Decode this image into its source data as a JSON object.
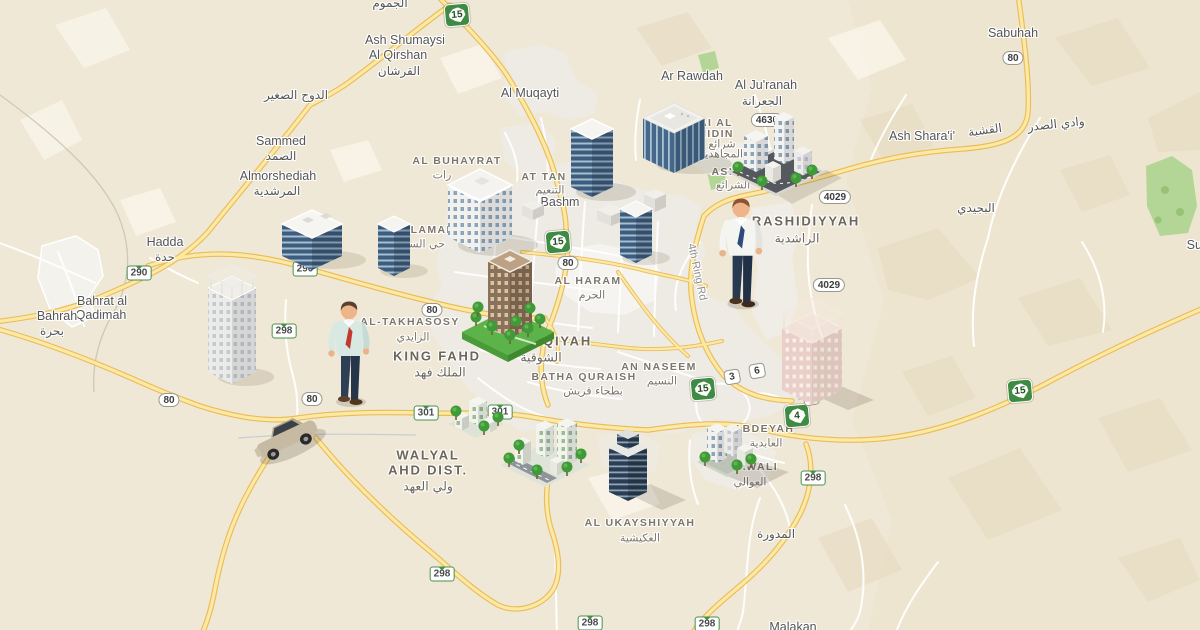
{
  "map": {
    "colors": {
      "background": "#f0e8d6",
      "urban": "#edebe4",
      "road_fill": "#fce9a6",
      "road_casing": "#eabc58",
      "road_local": "#ffffff",
      "green_area": "#b3d596",
      "terrain_shade": "#e3d6ba",
      "water": "#a8cae8",
      "shield_green": "#3f8b44"
    },
    "labels": [
      {
        "t": "الجموم",
        "x": 390,
        "y": 3,
        "c": "ar-town"
      },
      {
        "t": "Ash Shumaysi",
        "x": 405,
        "y": 40,
        "c": "town"
      },
      {
        "t": "Al Qirshan",
        "x": 398,
        "y": 55,
        "c": "town"
      },
      {
        "t": "القرشان",
        "x": 399,
        "y": 71,
        "c": "ar-town"
      },
      {
        "t": "Al Muqayti",
        "x": 530,
        "y": 93,
        "c": "town"
      },
      {
        "t": "الدوح الصغير",
        "x": 296,
        "y": 95,
        "c": "ar-town"
      },
      {
        "t": "Sammed",
        "x": 281,
        "y": 141,
        "c": "town"
      },
      {
        "t": "الصمد",
        "x": 281,
        "y": 156,
        "c": "ar-town"
      },
      {
        "t": "Almorshediah",
        "x": 278,
        "y": 176,
        "c": "town"
      },
      {
        "t": "المرشدية",
        "x": 277,
        "y": 191,
        "c": "ar-town"
      },
      {
        "t": "Hadda",
        "x": 165,
        "y": 242,
        "c": "town"
      },
      {
        "t": "حدة",
        "x": 165,
        "y": 257,
        "c": "ar-town"
      },
      {
        "t": "Bahrat al",
        "x": 102,
        "y": 301,
        "c": "town"
      },
      {
        "t": "Qadimah",
        "x": 101,
        "y": 315,
        "c": "town"
      },
      {
        "t": "Bahrah",
        "x": 57,
        "y": 316,
        "c": "town"
      },
      {
        "t": "بحرة",
        "x": 52,
        "y": 331,
        "c": "ar-town"
      },
      {
        "t": "AL BUHAYRAT",
        "x": 457,
        "y": 161,
        "c": "district"
      },
      {
        "t": "رات",
        "x": 442,
        "y": 175,
        "c": "ar-district"
      },
      {
        "t": "AT TAN",
        "x": 544,
        "y": 177,
        "c": "district"
      },
      {
        "t": "التنعيم",
        "x": 550,
        "y": 190,
        "c": "ar-district"
      },
      {
        "t": "Bashm",
        "x": 560,
        "y": 202,
        "c": "town"
      },
      {
        "t": "S SALAMAH",
        "x": 418,
        "y": 230,
        "c": "district"
      },
      {
        "t": "حي السلامة",
        "x": 418,
        "y": 244,
        "c": "ar-district"
      },
      {
        "t": "Ar Rawdah",
        "x": 692,
        "y": 76,
        "c": "town"
      },
      {
        "t": "Al Ju'ranah",
        "x": 766,
        "y": 85,
        "c": "town"
      },
      {
        "t": "الجعرانة",
        "x": 762,
        "y": 101,
        "c": "ar-town"
      },
      {
        "t": "ARAI AL",
        "x": 707,
        "y": 123,
        "c": "district"
      },
      {
        "t": "JAHIDIN",
        "x": 708,
        "y": 134,
        "c": "district"
      },
      {
        "t": "شرائع",
        "x": 722,
        "y": 144,
        "c": "ar-district"
      },
      {
        "t": "المجاهدين",
        "x": 720,
        "y": 154,
        "c": "ar-district"
      },
      {
        "t": "ASH S",
        "x": 731,
        "y": 172,
        "c": "district"
      },
      {
        "t": "الشرائع",
        "x": 733,
        "y": 185,
        "c": "ar-district"
      },
      {
        "t": "RASHIDIYYAH",
        "x": 806,
        "y": 221,
        "c": "district-big"
      },
      {
        "t": "الراشدية",
        "x": 797,
        "y": 238,
        "c": "ar-district-big"
      },
      {
        "t": "البجيدي",
        "x": 976,
        "y": 208,
        "c": "ar-town"
      },
      {
        "t": "Ash Shara'i'",
        "x": 922,
        "y": 136,
        "c": "town"
      },
      {
        "t": "القشبة",
        "x": 985,
        "y": 130,
        "c": "ar-town",
        "r": -8
      },
      {
        "t": "وادي الصدر",
        "x": 1056,
        "y": 124,
        "c": "ar-town",
        "r": -6
      },
      {
        "t": "Sabuhah",
        "x": 1013,
        "y": 33,
        "c": "town"
      },
      {
        "t": "Suf",
        "x": 1196,
        "y": 245,
        "c": "town"
      },
      {
        "t": "AL-TAKHASOSY",
        "x": 410,
        "y": 322,
        "c": "district"
      },
      {
        "t": "الزايدي",
        "x": 413,
        "y": 337,
        "c": "ar-district"
      },
      {
        "t": "KING FAHD",
        "x": 437,
        "y": 356,
        "c": "district-big"
      },
      {
        "t": "الملك فهد",
        "x": 440,
        "y": 372,
        "c": "ar-district-big"
      },
      {
        "t": "HOQIYAH",
        "x": 556,
        "y": 341,
        "c": "district-big"
      },
      {
        "t": "الشوقية",
        "x": 541,
        "y": 357,
        "c": "ar-district-big"
      },
      {
        "t": "AL HARAM",
        "x": 588,
        "y": 281,
        "c": "district"
      },
      {
        "t": "الحرم",
        "x": 592,
        "y": 295,
        "c": "ar-district"
      },
      {
        "t": "BATHA QURAISH",
        "x": 584,
        "y": 377,
        "c": "district"
      },
      {
        "t": "بطحاء قريش",
        "x": 593,
        "y": 391,
        "c": "ar-district"
      },
      {
        "t": "AN NASEEM",
        "x": 659,
        "y": 367,
        "c": "district"
      },
      {
        "t": "النسيم",
        "x": 662,
        "y": 381,
        "c": "ar-district"
      },
      {
        "t": "ABDEYAH",
        "x": 764,
        "y": 429,
        "c": "district"
      },
      {
        "t": "العابدية",
        "x": 766,
        "y": 443,
        "c": "ar-district"
      },
      {
        "t": "AWALI",
        "x": 758,
        "y": 467,
        "c": "district"
      },
      {
        "t": "العوالي",
        "x": 750,
        "y": 482,
        "c": "ar-district"
      },
      {
        "t": "WALYAL",
        "x": 428,
        "y": 455,
        "c": "district-big"
      },
      {
        "t": "AHD DIST.",
        "x": 428,
        "y": 470,
        "c": "district-big"
      },
      {
        "t": "ولي العهد",
        "x": 428,
        "y": 486,
        "c": "ar-district-big"
      },
      {
        "t": "AL UKAYSHIYYAH",
        "x": 640,
        "y": 523,
        "c": "district"
      },
      {
        "t": "العكيشية",
        "x": 640,
        "y": 538,
        "c": "ar-district"
      },
      {
        "t": "المدورة",
        "x": 776,
        "y": 534,
        "c": "ar-town"
      },
      {
        "t": "Malakan",
        "x": 793,
        "y": 627,
        "c": "town"
      },
      {
        "t": "4th Ring Rd",
        "x": 697,
        "y": 272,
        "c": "road-lbl",
        "r": 78
      }
    ],
    "shields": [
      {
        "n": "15",
        "t": "a",
        "x": 457,
        "y": 15
      },
      {
        "n": "15",
        "t": "a",
        "x": 558,
        "y": 242
      },
      {
        "n": "15",
        "t": "a",
        "x": 703,
        "y": 389
      },
      {
        "n": "15",
        "t": "a",
        "x": 1020,
        "y": 391
      },
      {
        "n": "4",
        "t": "a",
        "x": 797,
        "y": 416
      },
      {
        "n": "290",
        "t": "b",
        "x": 139,
        "y": 273
      },
      {
        "n": "290",
        "t": "b",
        "x": 305,
        "y": 269
      },
      {
        "n": "298",
        "t": "b",
        "x": 284,
        "y": 331
      },
      {
        "n": "298",
        "t": "b",
        "x": 442,
        "y": 574
      },
      {
        "n": "298",
        "t": "b",
        "x": 590,
        "y": 623
      },
      {
        "n": "298",
        "t": "b",
        "x": 707,
        "y": 624
      },
      {
        "n": "298",
        "t": "b",
        "x": 813,
        "y": 478
      },
      {
        "n": "301",
        "t": "b",
        "x": 426,
        "y": 413
      },
      {
        "n": "301",
        "t": "b",
        "x": 500,
        "y": 412
      },
      {
        "n": "80",
        "t": "c",
        "x": 169,
        "y": 400
      },
      {
        "n": "80",
        "t": "c",
        "x": 312,
        "y": 399
      },
      {
        "n": "80",
        "t": "c",
        "x": 432,
        "y": 310
      },
      {
        "n": "80",
        "t": "c",
        "x": 568,
        "y": 263
      },
      {
        "n": "80",
        "t": "c",
        "x": 1013,
        "y": 58
      },
      {
        "n": "4029",
        "t": "c",
        "x": 835,
        "y": 197
      },
      {
        "n": "4029",
        "t": "c",
        "x": 829,
        "y": 285
      },
      {
        "n": "4630",
        "t": "c",
        "x": 767,
        "y": 120
      },
      {
        "n": "3",
        "t": "c",
        "sq": true,
        "x": 732,
        "y": 377
      },
      {
        "n": "6",
        "t": "c",
        "sq": true,
        "x": 757,
        "y": 371
      },
      {
        "n": "7",
        "t": "c",
        "sq": true,
        "x": 811,
        "y": 398
      }
    ],
    "illustrations": [
      {
        "name": "mall-glass-building",
        "x": 674,
        "y": 158
      },
      {
        "name": "glass-tower-large",
        "x": 592,
        "y": 187
      },
      {
        "name": "sharai-city-block",
        "x": 776,
        "y": 172
      },
      {
        "name": "low-gray-buildings",
        "x": 533,
        "y": 215
      },
      {
        "name": "office-building-white",
        "x": 480,
        "y": 237
      },
      {
        "name": "glass-building-low",
        "x": 312,
        "y": 256
      },
      {
        "name": "glass-tower-small",
        "x": 636,
        "y": 255
      },
      {
        "name": "glass-tower-mid",
        "x": 394,
        "y": 268
      },
      {
        "name": "businessman-right-illustration",
        "x": 741,
        "y": 302,
        "s": 1.05
      },
      {
        "name": "park-brown-tower",
        "x": 508,
        "y": 332
      },
      {
        "name": "construction-tower",
        "x": 232,
        "y": 372
      },
      {
        "name": "pink-construction-building",
        "x": 812,
        "y": 390
      },
      {
        "name": "businessman-left-illustration",
        "x": 349,
        "y": 400
      },
      {
        "name": "small-city-block",
        "x": 476,
        "y": 424
      },
      {
        "name": "car-illustration",
        "x": 289,
        "y": 443
      },
      {
        "name": "awali-city-block",
        "x": 727,
        "y": 462
      },
      {
        "name": "walyal-city-block",
        "x": 545,
        "y": 465
      },
      {
        "name": "ukayshiyyah-tower",
        "x": 628,
        "y": 492
      }
    ]
  }
}
